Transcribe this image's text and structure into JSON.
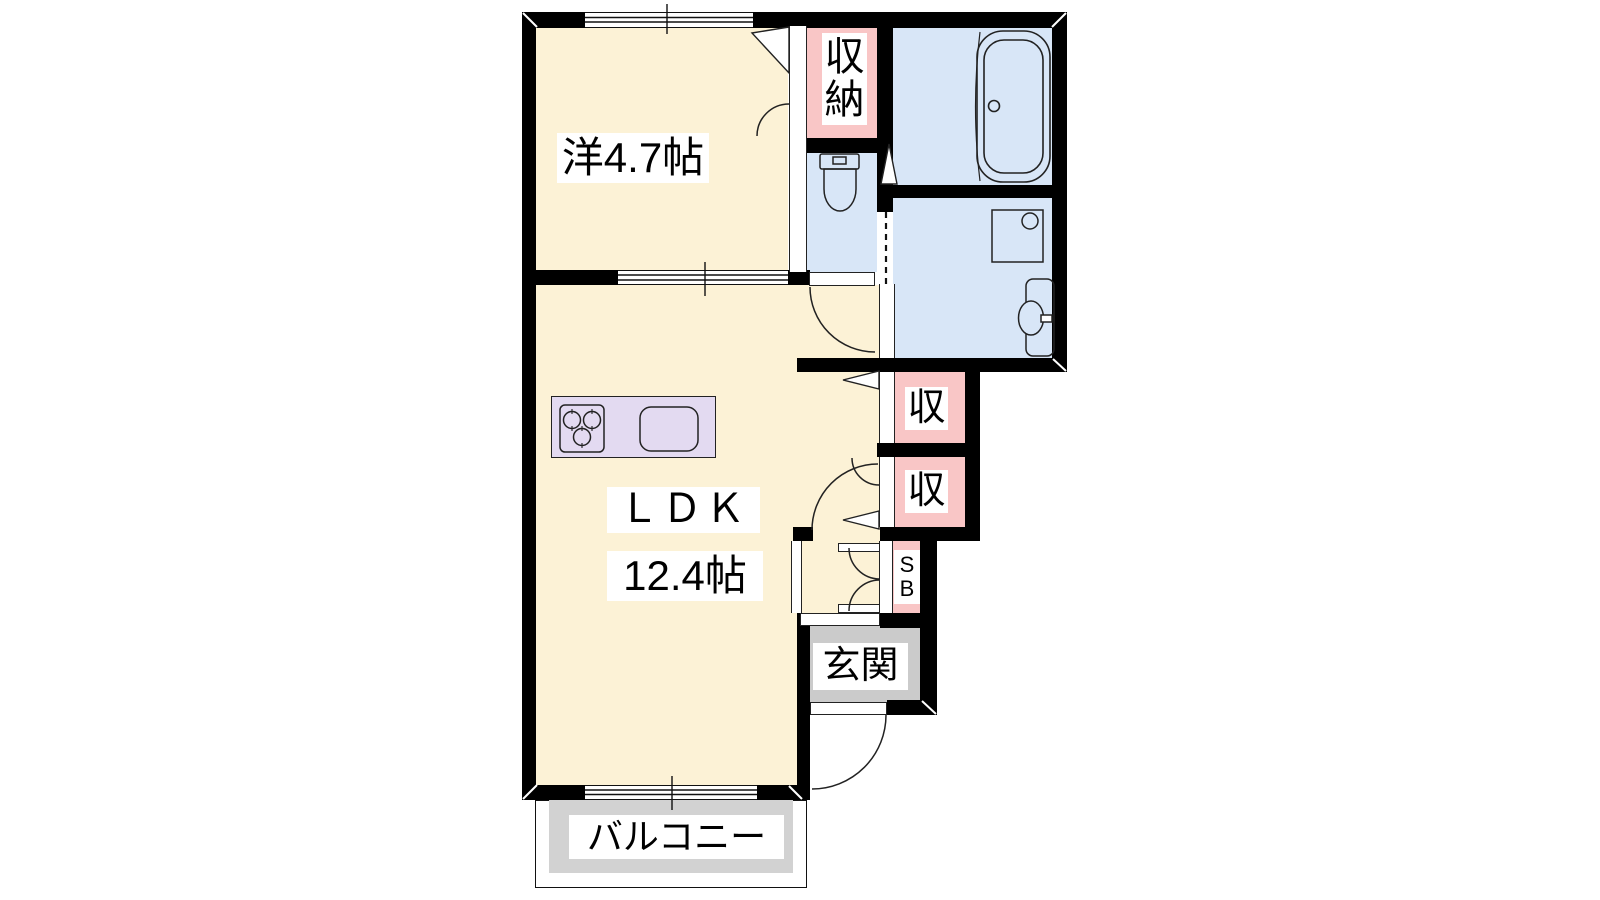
{
  "plan": {
    "type": "apartment-floor-plan-1LDK",
    "rooms": {
      "western_room": {
        "label": "洋4.7帖"
      },
      "ldk": {
        "label": "ＬＤＫ",
        "area_label": "12.4帖"
      },
      "closet": {
        "chars": [
          "収",
          "納"
        ]
      },
      "storage_upper": {
        "label": "収"
      },
      "storage_lower": {
        "label": "収"
      },
      "shoe_box": {
        "chars": [
          "S",
          "B"
        ]
      },
      "entrance": {
        "label": "玄関"
      },
      "balcony": {
        "label": "バルコニー"
      }
    },
    "fixtures": [
      "bathtub",
      "toilet",
      "washing-machine-pan",
      "vanity-sink",
      "stove-3-burner",
      "kitchen-sink"
    ],
    "colors": {
      "wall": "#000000",
      "room_floor": "#FCF2D6",
      "storage_fill": "#F9C6C6",
      "wet_area_fill": "#D8E6F7",
      "kitchen_counter": "#E3DAF1",
      "entrance_fill": "#CBCBCB",
      "balcony_fill": "#D2D2D2",
      "line": "#222222"
    }
  }
}
